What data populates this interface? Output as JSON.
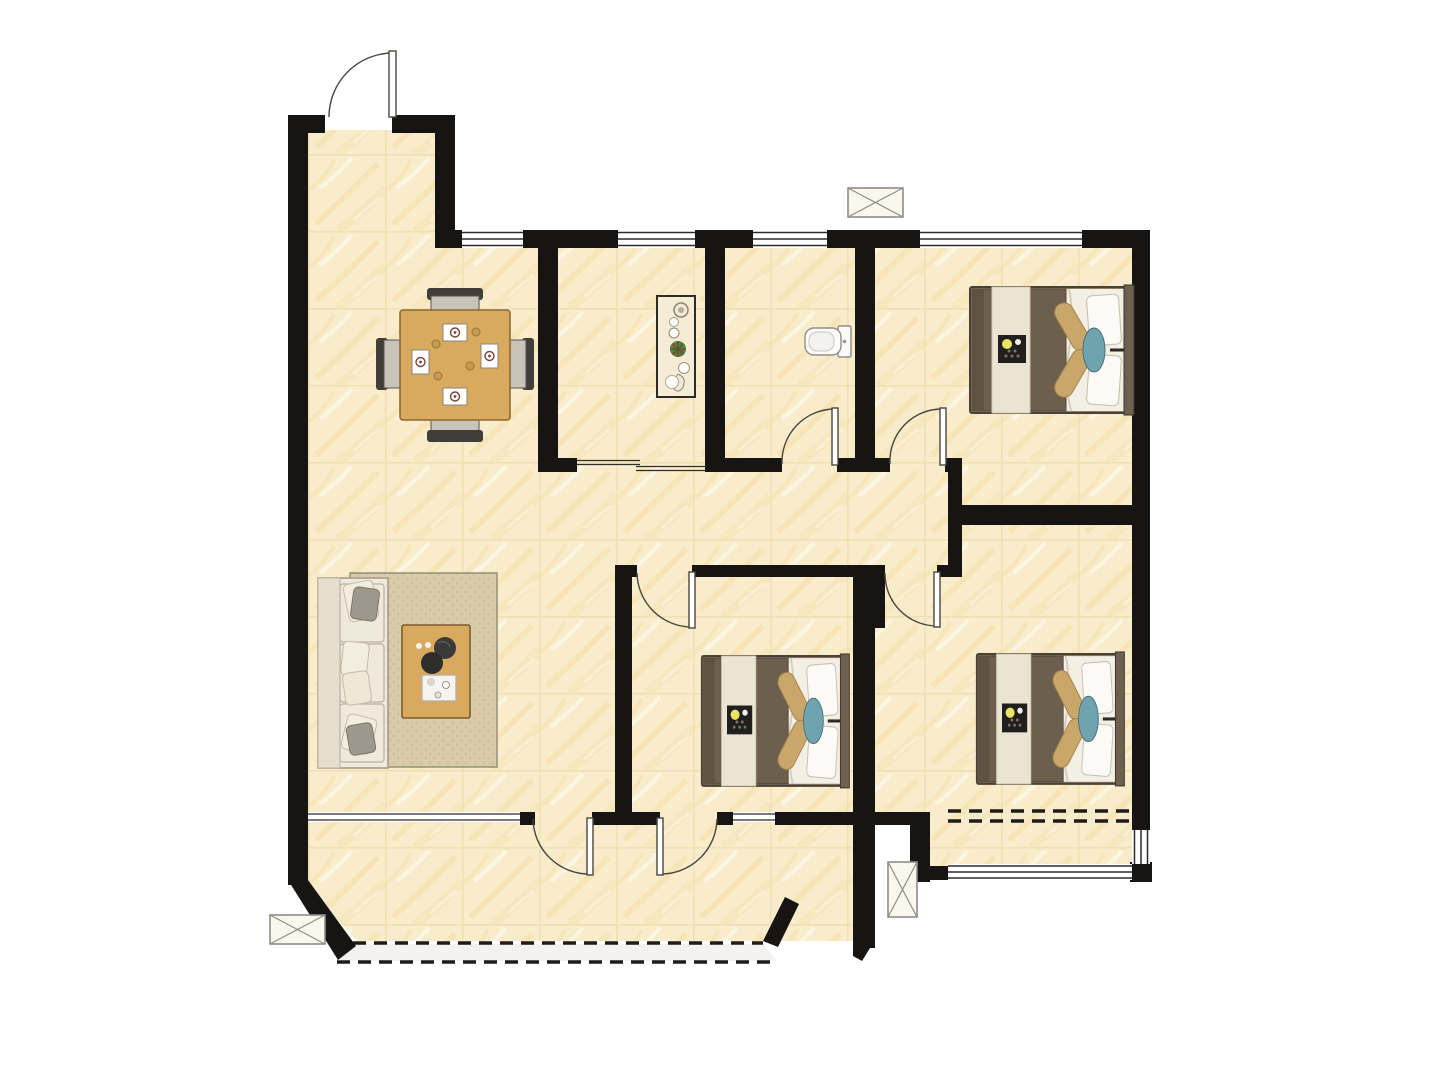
{
  "meta": {
    "type": "floorplan",
    "description": "Top-down furnished floor plan of a 3-bedroom apartment, no text labels visible",
    "bedroom_count": 3,
    "balcony_count": 2
  },
  "palette": {
    "background": "#ffffff",
    "wall": "#161514",
    "floor": "#f8ecca",
    "floor_grout": "#eddfae",
    "floor_streak": "#f5d48c",
    "window_line": "#2e2c29",
    "door_line": "#4a463f",
    "dashed_line": "#1d1c1a",
    "balcony_slab": "#f3f2ef",
    "wood": "#d9aa5d",
    "rug": "#d8cba8",
    "sofa": "#efe9db",
    "blanket": "#6d5f4e",
    "bed_runner": "#ebe4d2",
    "bolster": "#c9a66a",
    "teal_cushion": "#6fa3ad",
    "tray_dark": "#201f1d",
    "tray_dot_yellow": "#e9e462",
    "plant_green": "#5d7a44",
    "ac_box_fill": "#faf7ee",
    "ac_box_line": "#8f8d88"
  },
  "inventory": {
    "rooms": [
      {
        "name": "entry"
      },
      {
        "name": "dining-area"
      },
      {
        "name": "kitchen"
      },
      {
        "name": "bathroom"
      },
      {
        "name": "bedroom-top-right"
      },
      {
        "name": "hallway"
      },
      {
        "name": "living-room"
      },
      {
        "name": "bedroom-middle"
      },
      {
        "name": "bedroom-bottom-right"
      },
      {
        "name": "balcony-main"
      },
      {
        "name": "balcony-right"
      }
    ],
    "furniture": [
      {
        "name": "dining-table",
        "chairs": 4,
        "place_settings": 4
      },
      {
        "name": "kitchen-console",
        "decor_items": 6
      },
      {
        "name": "toilet"
      },
      {
        "name": "double-bed",
        "count": 3
      },
      {
        "name": "sofa"
      },
      {
        "name": "area-rug"
      },
      {
        "name": "coffee-table"
      }
    ],
    "symbols": [
      {
        "name": "ac-outdoor-unit",
        "count": 3
      },
      {
        "name": "door-swing",
        "count": 7
      },
      {
        "name": "window",
        "count": 9
      },
      {
        "name": "balcony-dashed-edge",
        "count": 2
      }
    ]
  }
}
